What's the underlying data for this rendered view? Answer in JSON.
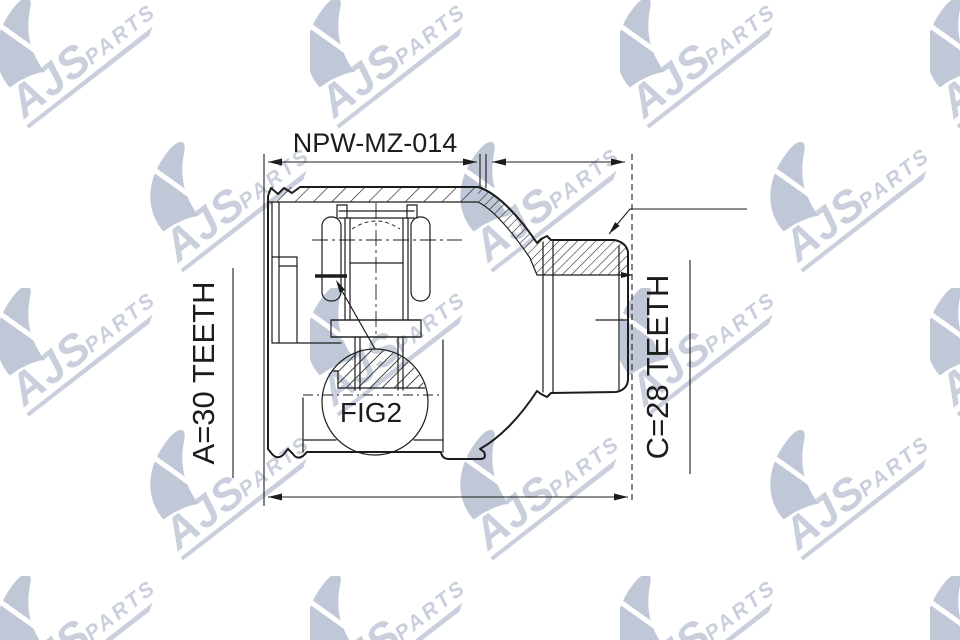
{
  "drawing": {
    "part_number": "NPW-MZ-014",
    "dimension_a_label": "A=30 TEETH",
    "dimension_c_label": "C=28 TEETH",
    "figure_label": "FIG2"
  },
  "watermark": {
    "brand": "AJS",
    "suffix": "PARTS"
  },
  "colors": {
    "line": "#1c1c1c",
    "watermark": "#c6ccdb",
    "watermark_dark": "#bdc5d6",
    "background": "#ffffff"
  }
}
